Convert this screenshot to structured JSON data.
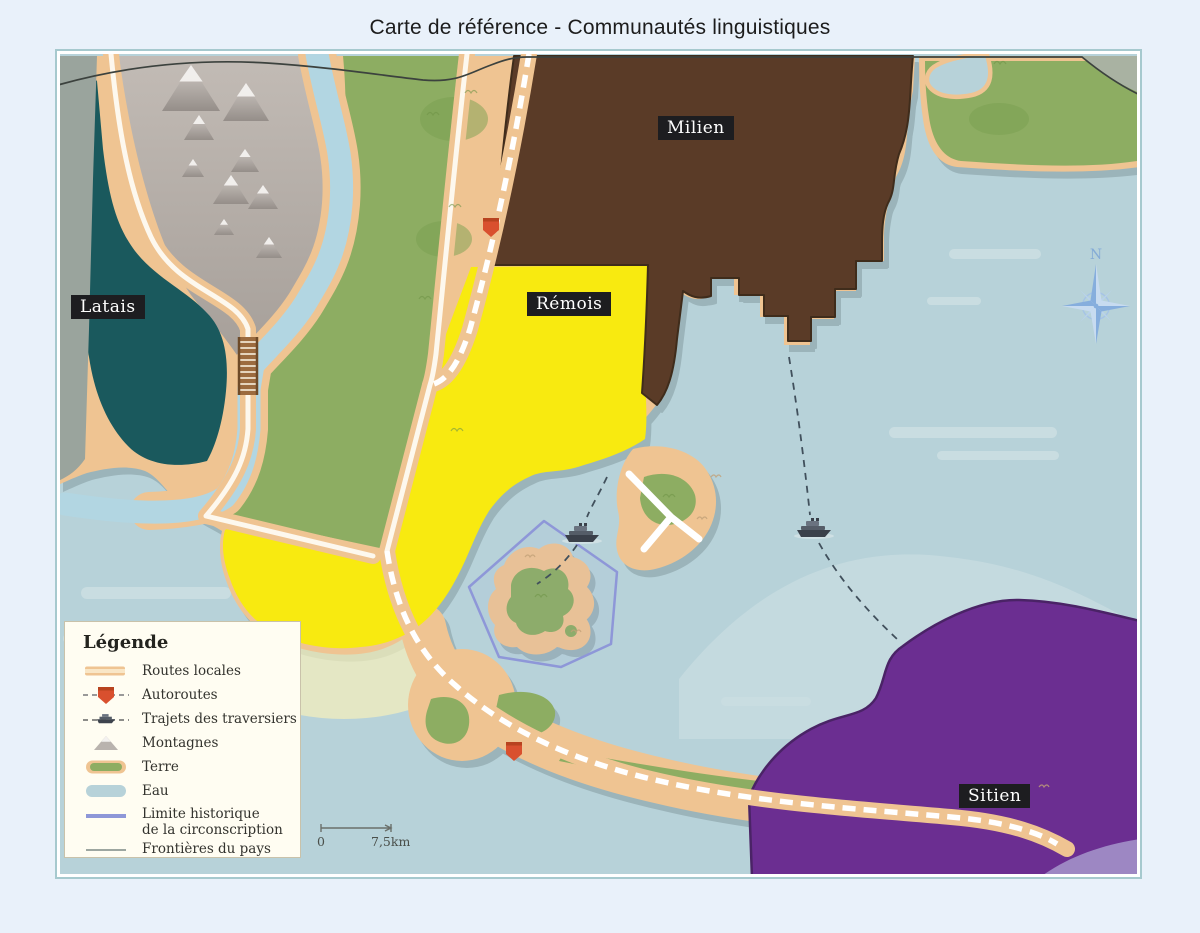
{
  "title": "Carte de référence - Communautés linguistiques",
  "regions": {
    "latais": {
      "label": "Latais"
    },
    "milien": {
      "label": "Milien"
    },
    "remois": {
      "label": "Rémois"
    },
    "sitien": {
      "label": "Sitien"
    }
  },
  "legend": {
    "title": "Légende",
    "items": [
      {
        "label": "Routes locales"
      },
      {
        "label": "Autoroutes"
      },
      {
        "label": "Trajets des traversiers"
      },
      {
        "label": "Montagnes"
      },
      {
        "label": "Terre"
      },
      {
        "label": "Eau"
      },
      {
        "label": "Limite historique",
        "label2": "de la circonscription"
      },
      {
        "label": "Frontières du pays"
      }
    ]
  },
  "compass": {
    "north_label": "N"
  },
  "scale": {
    "start_label": "0",
    "end_label": "7,5km"
  },
  "colors": {
    "page_bg": "#e9f1fa",
    "frame": "#a6c9ce",
    "water": "#b7d2d9",
    "water_light": "#c9dde1",
    "sand": "#efc492",
    "green": "#8dad62",
    "green_dark": "#79a050",
    "gray_strip": "#9aa49d",
    "teal": "#1a595d",
    "brown": "#5a3b27",
    "brown_dark": "#3f2c1b",
    "yellow": "#f8ea10",
    "yellow_pale": "#f7f0bb",
    "purple": "#6b2e91",
    "purple_dark": "#4a2366",
    "purple_light": "#9d87c3",
    "lavender": "#8e97d8",
    "river": "#b2d6e2",
    "road_line": "#fdf8ee",
    "highway_red": "#d9502e",
    "ferry": "#3d434d",
    "border_line": "#3c423e",
    "label_bg": "#1d1d20",
    "legend_bg": "#fffdf2"
  }
}
